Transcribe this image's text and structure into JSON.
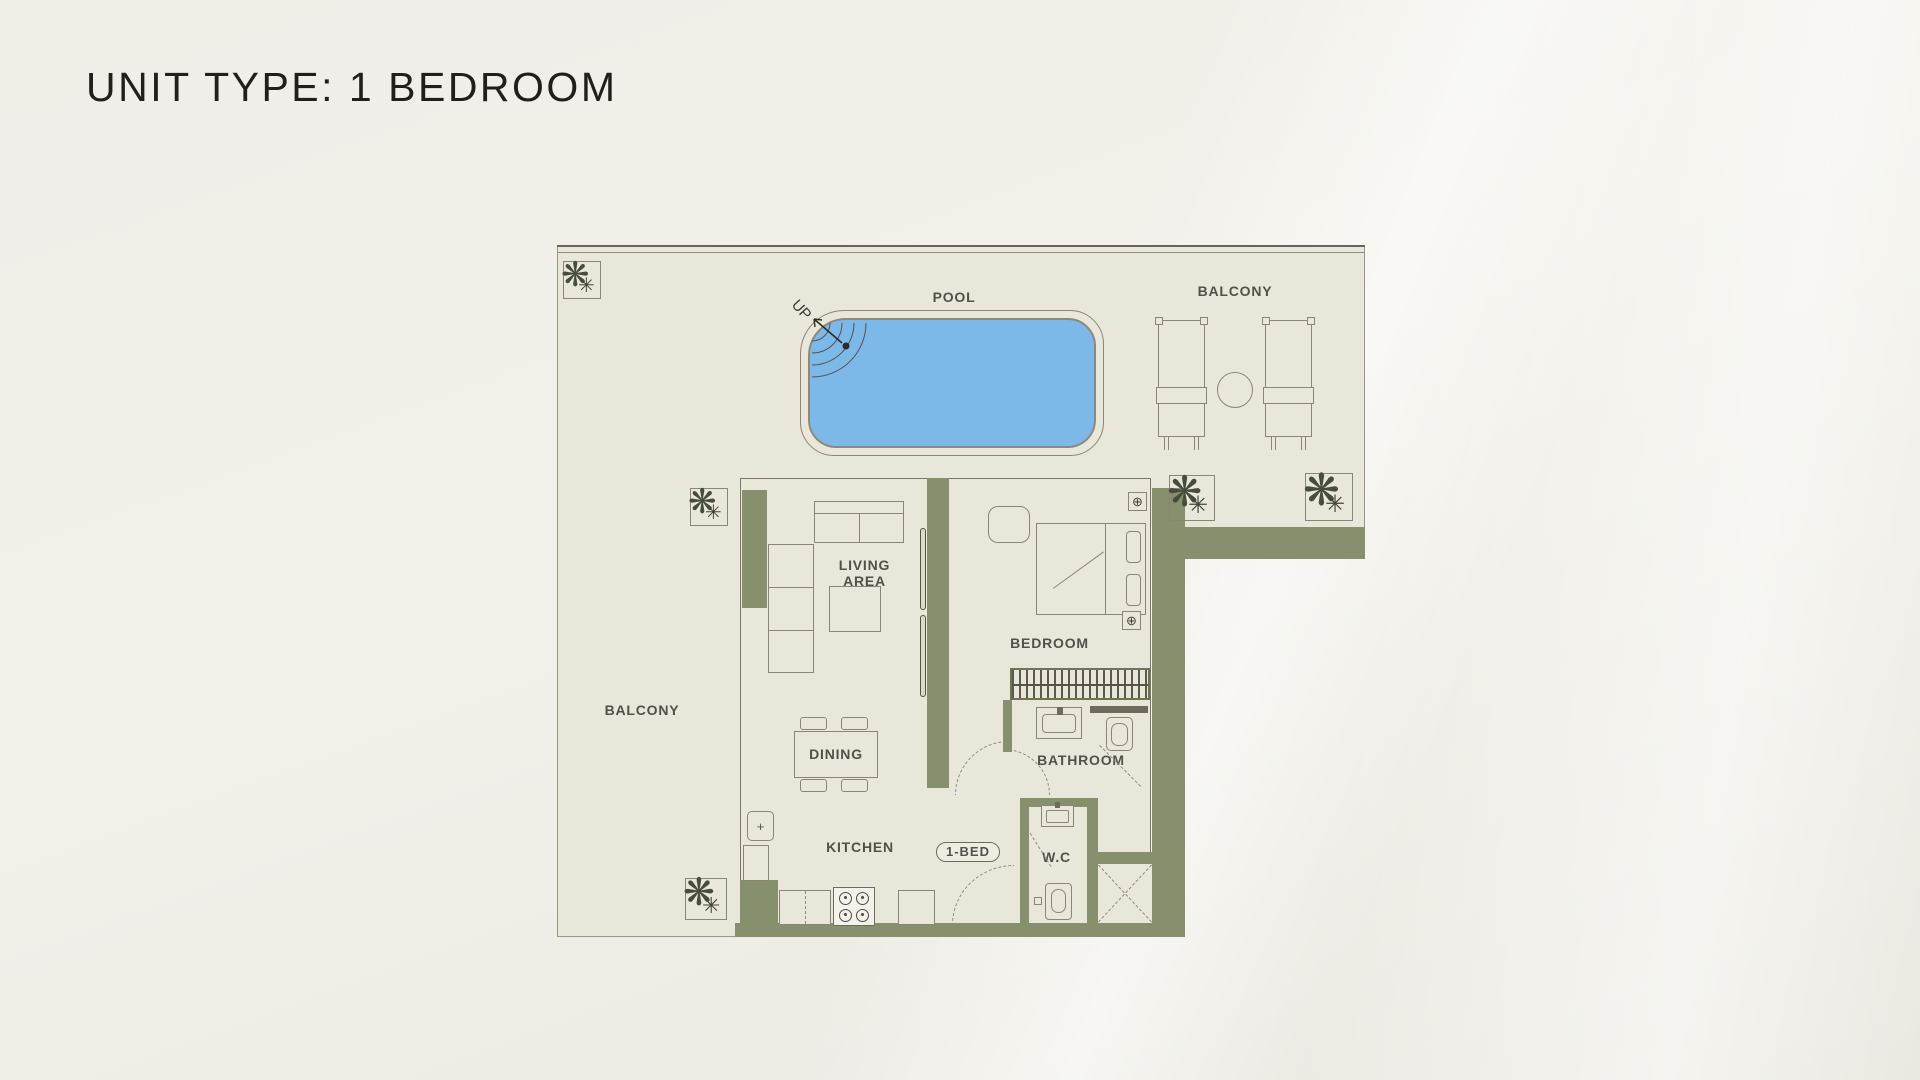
{
  "title": "UNIT TYPE: 1 BEDROOM",
  "plan": {
    "labels": {
      "pool": "POOL",
      "balcony_top": "BALCONY",
      "balcony_left": "BALCONY",
      "living_line1": "LIVING",
      "living_line2": "AREA",
      "bedroom": "BEDROOM",
      "dining": "DINING",
      "bathroom": "BATHROOM",
      "kitchen": "KITCHEN",
      "wc": "W.C",
      "unit_badge": "1-BED",
      "up": "UP"
    },
    "icons": {
      "wall_light": "⊕",
      "plant": "❋",
      "plant_small": "✳",
      "fridge_plus": "+"
    },
    "colors": {
      "page_background": "#f0eee7",
      "floor": "#e9e6da",
      "wall_accent": "#87906c",
      "line": "#8b8578",
      "pool_water": "#7cb8e8",
      "label_text": "#3a372f",
      "title_text": "#221f1a",
      "plant_foliage": "#474d3d"
    }
  }
}
